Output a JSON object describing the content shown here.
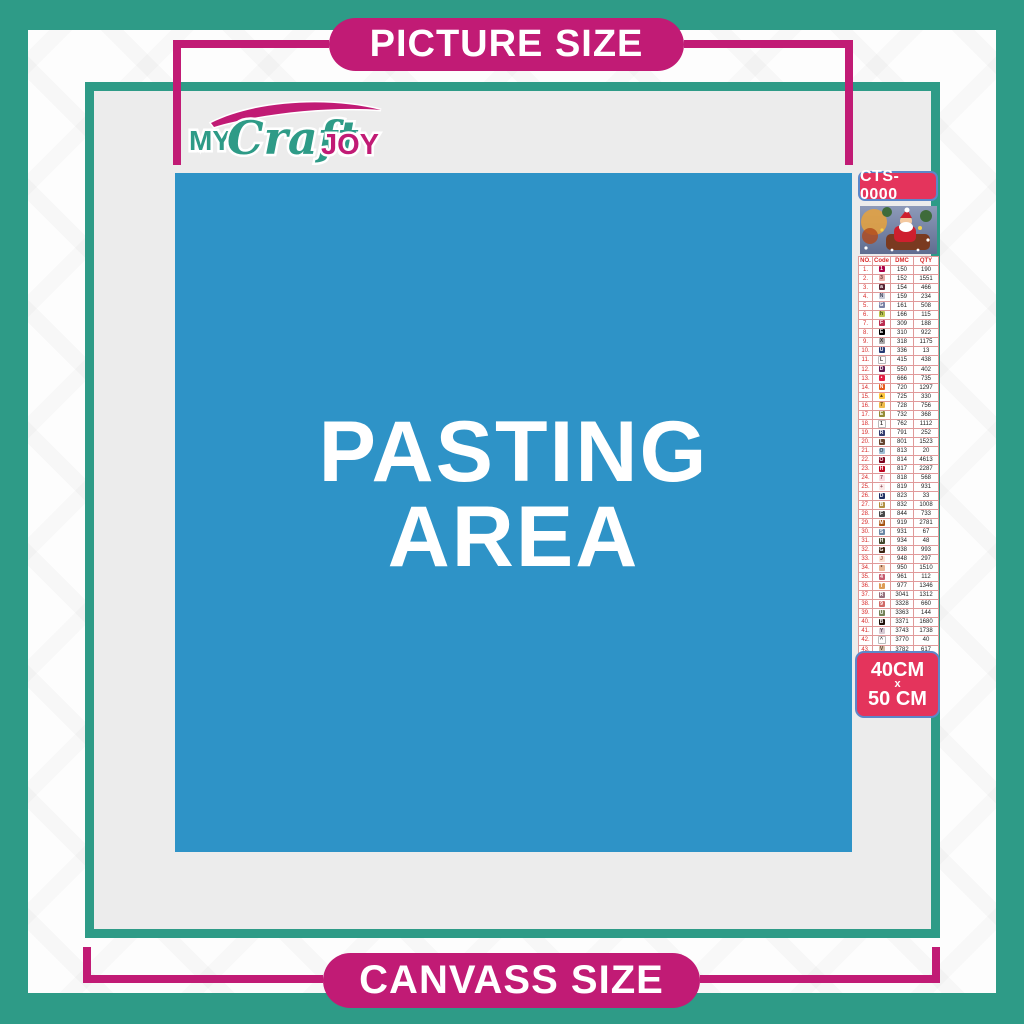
{
  "banners": {
    "top_label": "PICTURE SIZE",
    "bottom_label": "CANVASS SIZE"
  },
  "logo": {
    "word1": "MY",
    "word2": "Craft",
    "word3": "JOY"
  },
  "pasting_area": {
    "line1": "PASTING",
    "line2": "AREA"
  },
  "product": {
    "code": "CTS-0000",
    "size_line1": "40CM",
    "size_sep": "x",
    "size_line2": "50 CM"
  },
  "color_chart": {
    "headers": [
      "NO.",
      "Code",
      "DMC",
      "QTY"
    ],
    "rows": [
      {
        "no": "1.",
        "sym": "1",
        "bg": "#AB0249",
        "fg": "#ffffff",
        "dmc": "150",
        "qty": "190"
      },
      {
        "no": "2.",
        "sym": "3",
        "bg": "#E8ADA9",
        "fg": "#6b3a3a",
        "dmc": "152",
        "qty": "1551"
      },
      {
        "no": "3.",
        "sym": "a",
        "bg": "#572433",
        "fg": "#ffffff",
        "dmc": "154",
        "qty": "466"
      },
      {
        "no": "4.",
        "sym": "N",
        "bg": "#C7CAD7",
        "fg": "#44485e",
        "dmc": "159",
        "qty": "234"
      },
      {
        "no": "5.",
        "sym": "G",
        "bg": "#7880A4",
        "fg": "#ffffff",
        "dmc": "161",
        "qty": "508"
      },
      {
        "no": "6.",
        "sym": "h",
        "bg": "#BDC653",
        "fg": "#45481c",
        "dmc": "166",
        "qty": "115"
      },
      {
        "no": "7.",
        "sym": "F",
        "bg": "#BA2C50",
        "fg": "#ffffff",
        "dmc": "309",
        "qty": "188"
      },
      {
        "no": "8.",
        "sym": "E",
        "bg": "#000000",
        "fg": "#ffffff",
        "dmc": "310",
        "qty": "922"
      },
      {
        "no": "9.",
        "sym": "X",
        "bg": "#ABABAB",
        "fg": "#333333",
        "dmc": "318",
        "qty": "1175"
      },
      {
        "no": "10.",
        "sym": "U",
        "bg": "#253B73",
        "fg": "#ffffff",
        "dmc": "336",
        "qty": "13"
      },
      {
        "no": "11.",
        "sym": "L",
        "bg": "#ffffff",
        "fg": "#333333",
        "dmc": "415",
        "qty": "438"
      },
      {
        "no": "12.",
        "sym": "D",
        "bg": "#5C1A51",
        "fg": "#ffffff",
        "dmc": "550",
        "qty": "402"
      },
      {
        "no": "13.",
        "sym": "•",
        "bg": "#E31D42",
        "fg": "#ffffff",
        "dmc": "666",
        "qty": "735"
      },
      {
        "no": "14.",
        "sym": "N",
        "bg": "#E55C1F",
        "fg": "#ffffff",
        "dmc": "720",
        "qty": "1297"
      },
      {
        "no": "15.",
        "sym": "▲",
        "bg": "#FFC840",
        "fg": "#554411",
        "dmc": "725",
        "qty": "330"
      },
      {
        "no": "16.",
        "sym": "7",
        "bg": "#EFBB4C",
        "fg": "#554411",
        "dmc": "728",
        "qty": "756"
      },
      {
        "no": "17.",
        "sym": "E",
        "bg": "#938B37",
        "fg": "#ffffff",
        "dmc": "732",
        "qty": "368"
      },
      {
        "no": "18.",
        "sym": "1",
        "bg": "#ffffff",
        "fg": "#333333",
        "dmc": "762",
        "qty": "1112"
      },
      {
        "no": "19.",
        "sym": "R",
        "bg": "#343B6E",
        "fg": "#ffffff",
        "dmc": "791",
        "qty": "252"
      },
      {
        "no": "20.",
        "sym": "L",
        "bg": "#65452E",
        "fg": "#ffffff",
        "dmc": "801",
        "qty": "1523"
      },
      {
        "no": "21.",
        "sym": "O",
        "bg": "#A1C2D7",
        "fg": "#334455",
        "dmc": "813",
        "qty": "20"
      },
      {
        "no": "22.",
        "sym": "O",
        "bg": "#7B001B",
        "fg": "#ffffff",
        "dmc": "814",
        "qty": "4613"
      },
      {
        "no": "23.",
        "sym": "H",
        "bg": "#BB051F",
        "fg": "#ffffff",
        "dmc": "817",
        "qty": "2287"
      },
      {
        "no": "24.",
        "sym": "7",
        "bg": "#FADDE2",
        "fg": "#884455",
        "dmc": "818",
        "qty": "568"
      },
      {
        "no": "25.",
        "sym": "+",
        "bg": "#FBE9E7",
        "fg": "#884455",
        "dmc": "819",
        "qty": "931"
      },
      {
        "no": "26.",
        "sym": "D",
        "bg": "#213063",
        "fg": "#ffffff",
        "dmc": "823",
        "qty": "33"
      },
      {
        "no": "27.",
        "sym": "B",
        "bg": "#B08F42",
        "fg": "#ffffff",
        "dmc": "832",
        "qty": "1008"
      },
      {
        "no": "28.",
        "sym": "F",
        "bg": "#484848",
        "fg": "#ffffff",
        "dmc": "844",
        "qty": "733"
      },
      {
        "no": "29.",
        "sym": "M",
        "bg": "#A5520F",
        "fg": "#ffffff",
        "dmc": "919",
        "qty": "2781"
      },
      {
        "no": "30.",
        "sym": "S",
        "bg": "#6A87A5",
        "fg": "#ffffff",
        "dmc": "931",
        "qty": "67"
      },
      {
        "no": "31.",
        "sym": "H",
        "bg": "#3F462A",
        "fg": "#ffffff",
        "dmc": "934",
        "qty": "48"
      },
      {
        "no": "32.",
        "sym": "G",
        "bg": "#3B2412",
        "fg": "#ffffff",
        "dmc": "938",
        "qty": "993"
      },
      {
        "no": "33.",
        "sym": "J",
        "bg": "#FBE3D4",
        "fg": "#995544",
        "dmc": "948",
        "qty": "297"
      },
      {
        "no": "34.",
        "sym": "*",
        "bg": "#E8B896",
        "fg": "#553322",
        "dmc": "950",
        "qty": "1510"
      },
      {
        "no": "35.",
        "sym": "4",
        "bg": "#C65C6E",
        "fg": "#ffffff",
        "dmc": "961",
        "qty": "112"
      },
      {
        "no": "36.",
        "sym": "T",
        "bg": "#DC9C56",
        "fg": "#ffffff",
        "dmc": "977",
        "qty": "1346"
      },
      {
        "no": "37.",
        "sym": "R",
        "bg": "#956F7C",
        "fg": "#ffffff",
        "dmc": "3041",
        "qty": "1312"
      },
      {
        "no": "38.",
        "sym": "9",
        "bg": "#D06A66",
        "fg": "#ffffff",
        "dmc": "3328",
        "qty": "660"
      },
      {
        "no": "39.",
        "sym": "U",
        "bg": "#728256",
        "fg": "#ffffff",
        "dmc": "3363",
        "qty": "144"
      },
      {
        "no": "40.",
        "sym": "B",
        "bg": "#1E1108",
        "fg": "#ffffff",
        "dmc": "3371",
        "qty": "1680"
      },
      {
        "no": "41.",
        "sym": "Y",
        "bg": "#D7CBD3",
        "fg": "#554455",
        "dmc": "3743",
        "qty": "1738"
      },
      {
        "no": "42.",
        "sym": "^",
        "bg": "#ffffff",
        "fg": "#333333",
        "dmc": "3770",
        "qty": "40"
      },
      {
        "no": "43.",
        "sym": "V",
        "bg": "#D2BCA6",
        "fg": "#554433",
        "dmc": "3782",
        "qty": "617"
      },
      {
        "no": "44.",
        "sym": "Z",
        "bg": "#D8E04F",
        "fg": "#555522",
        "dmc": "3819",
        "qty": "119"
      },
      {
        "no": "45.",
        "sym": "✓",
        "bg": "#FDF4CC",
        "fg": "#555522",
        "dmc": "3823",
        "qty": "107"
      },
      {
        "no": "46.",
        "sym": "C",
        "bg": "#F29746",
        "fg": "#ffffff",
        "dmc": "3853",
        "qty": "1332"
      },
      {
        "no": "47.",
        "sym": "D",
        "bg": "#83402E",
        "fg": "#ffffff",
        "dmc": "3858",
        "qty": "2311"
      },
      {
        "no": "48.",
        "sym": "A",
        "bg": "#A4835C",
        "fg": "#ffffff",
        "dmc": "3863",
        "qty": "1820"
      }
    ]
  },
  "colors": {
    "teal": "#2E9B87",
    "magenta": "#C11B75",
    "blue": "#2E93C7",
    "crimson": "#E4345C",
    "badge_border": "#5C87C9",
    "panel_gray": "#ECECEC",
    "table_line": "#E09A9A"
  }
}
